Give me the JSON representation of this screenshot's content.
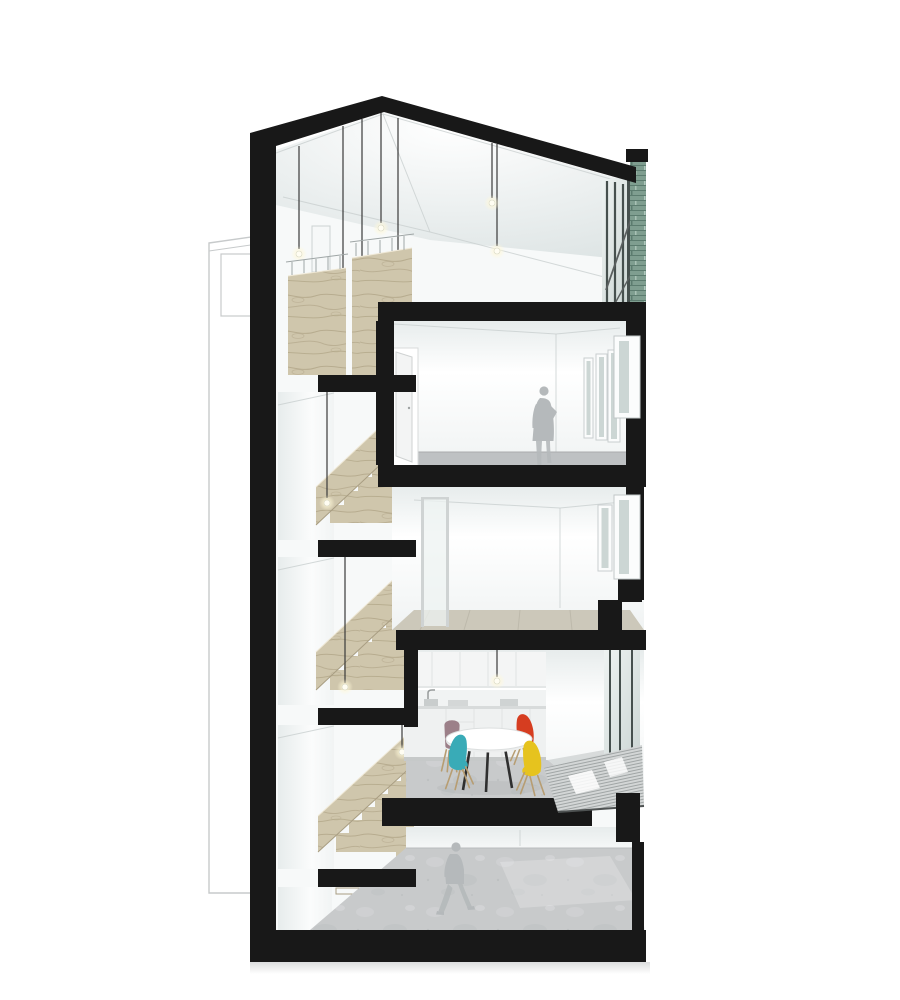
{
  "page": {
    "background": "#ffffff",
    "description": "Architectural cross-section rendering of a narrow four-storey house: left stair core with plywood flights and black cantilevered landings, top studio under a pitched roof with pendant bulbs and green channel-glass facade, a bedroom with standing woman, an empty room with window bay, a kitchen-diner with round table and four coloured chairs, and a ground floor with walking man"
  },
  "palette": {
    "cut_black": "#181818",
    "wall_white": "#f7f9f9",
    "wall_shade": "#e7ecec",
    "ceiling_shade": "#dde4e4",
    "wood": "#cfc6ac",
    "wood_grain": "#b3a78a",
    "wood_edge": "#efe8d6",
    "wood_dark": "#a89d82",
    "concrete": "#c8cacb",
    "concrete_dark": "#bec1c3",
    "glass_light": "#eef3f2",
    "glass_dark": "#ccd6d4",
    "mullion": "#46504e",
    "green_glass": "#7f9e90",
    "green_glass_dark": "#5c7c6f",
    "green_glass_light": "#bad0c5",
    "outline_gray": "#c7cacb",
    "figure_gray": "#b5b9bb",
    "deck_base": "#d3d6d6",
    "deck_line": "#9aa0a0",
    "chair_teal": "#39abb7",
    "chair_red": "#d63d20",
    "chair_yellow": "#e6c31e",
    "chair_mauve": "#9c8089",
    "chair_leg": "#b79d72",
    "table_leg": "#2f2f2f",
    "pendant_cord": "#3a3a3a",
    "bulb": "#fffdf2",
    "shadow": "#e4e6e7"
  },
  "scene": {
    "neighbor_outline": "adjacent-building-outline",
    "roof": "pitched-roof-cut",
    "facade_top": "green-channel-glass-panel",
    "stair_core": {
      "flights": 4,
      "material": "plywood",
      "landings": "black-steel-slabs"
    },
    "floors": [
      "loft-studio",
      "bedroom",
      "empty-room",
      "kitchen-diner",
      "ground-floor"
    ],
    "figures": [
      {
        "name": "standing-woman",
        "floor": "bedroom"
      },
      {
        "name": "walking-man",
        "floor": "ground-floor"
      }
    ],
    "furniture": {
      "dining_table": "round-white-pedestal-table",
      "chairs": [
        {
          "name": "dining-chair-mauve"
        },
        {
          "name": "dining-chair-red"
        },
        {
          "name": "dining-chair-teal"
        },
        {
          "name": "dining-chair-yellow"
        }
      ],
      "kitchen": "white-fitted-kitchen-with-under-cabinet-light"
    },
    "lighting": "bare-bulb-pendants"
  }
}
